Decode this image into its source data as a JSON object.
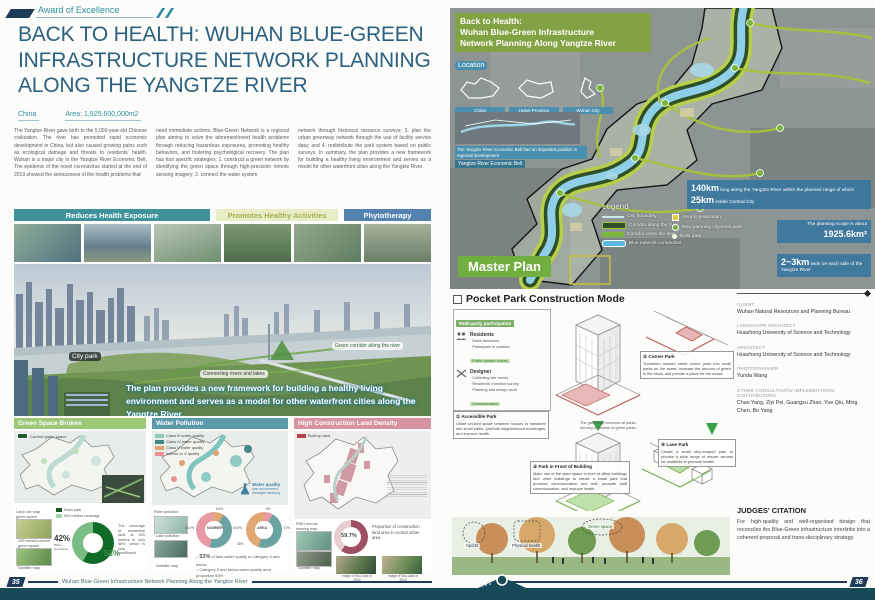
{
  "colors": {
    "accent_teal": "#2e8fa0",
    "title_blue": "#2b607f",
    "footer_navy": "#1e3c5a",
    "banner_teal": "#3f919b",
    "banner_yellow": "#e9edc6",
    "banner_blue": "#5381b0",
    "panel_green": "#9cc878",
    "panel_teal": "#5b9aa8",
    "panel_pink": "#d893a1",
    "callout_blue": "#38769e",
    "master_green": "#6fae3f"
  },
  "award": {
    "label": "Award of Excellence"
  },
  "left": {
    "title": "BACK TO HEALTH: WUHAN BLUE-GREEN INFRASTRUCTURE NETWORK PLANNING ALONG THE YANGTZE RIVER",
    "country": "China",
    "area": "Area: 1,925,600,000m2",
    "intro_col1": "The Yangtze River gave birth to the 5,000-year-old Chinese civilization. The river has promoted rapid economic development in China, but also caused growing pains such as ecological damage and threats to residents' health. Wuhan is a major city in the Yangtze River Economic Belt. The epidemic of the novel coronavirus started at the end of 2019 showed the seriousness of the health problems that",
    "intro_col2": "need immediate actions. Blue-Green Network is a regional plan aiming to solve the aforementioned health problems through reducing hazardous exposures, promoting healthy behaviors, and fostering psychological recovery. The plan has four specific strategies: 1. construct a green network by identifying the green space through high-precision remote sensing imagery; 2. connect the water system",
    "intro_col3": "network through historical resource surveys; 3. plan the urban greenway network through the use of facility service data; and 4. redistribute the park system based on public surveys. In summary, the plan provides a new framework for building a healthy living environment and serves as a model for other waterfront cities along the Yangtze River.",
    "banners": [
      "Reduces Health Exposure",
      "Promotes Healthy Activities",
      "Phytotherapy"
    ],
    "panorama": {
      "label_city_park": "City park",
      "label_corridor": "Green corridor along the river",
      "label_connect": "Connecting rivers and lakes",
      "caption": "The plan provides a new framework for building a healthy living environment and serves as a model for other waterfront cities along the Yangtze River."
    },
    "panels": {
      "green": {
        "title": "Green Space Broken",
        "legend": "Current green space",
        "map_labels": [
          "Land use map green space",
          "GIS extract current green space",
          "Satellite map"
        ],
        "mini_legend": [
          "Each park",
          "500 meters coverage"
        ],
        "donut": {
          "pct_left": "42%",
          "pct_left_sub": "500m uncovered",
          "pct_right": "58%",
          "values": [
            42,
            58
          ]
        },
        "note": "The coverage of residential land at 500 meters is only 58%, which is very insufficient."
      },
      "water": {
        "title": "Water Pollution",
        "legend": [
          "Class III water quality",
          "Class IV water quality",
          "Class V water quality",
          "Inferior to V quality"
        ],
        "flask_title": "Water quality",
        "flask_sub": "river environment damaged seriously",
        "map_labels": [
          "River pollution",
          "Lake pollution",
          "Satellite map"
        ],
        "donuts": [
          {
            "center": "NUMBER",
            "seg1": "8.8%",
            "seg2": "44.8%",
            "seg3": "46.4%",
            "values": [
              8.8,
              44.8,
              46.4
            ]
          },
          {
            "center": "AREA",
            "seg1": "8%",
            "seg2": "47%",
            "seg3": "45%",
            "values": [
              8,
              47,
              45
            ]
          }
        ],
        "note1_pre": "– ",
        "note1_big": "53%",
        "note1_rest": " of lake water quality in Category 5 and below",
        "note2": "– Category 5 and below water quality area proportion 53%"
      },
      "construction": {
        "title": "High Construction Land Density",
        "legend": "Built-up land",
        "map_labels": [
          "RSEI remote sensing map",
          "Satellite map"
        ],
        "donut_pct": "59.7%",
        "note": "Proportion of construction land area in central urban area",
        "images": [
          "Image of Sha Lake in 2000",
          "Image of Sha Lake in 2013"
        ]
      }
    },
    "footer": {
      "page": "35",
      "text": "Wuhan Blue-Green Infrastructure Network Planning Along the Yangtze River"
    }
  },
  "right": {
    "map": {
      "banner1": "Back to Health:",
      "banner2": "Wuhan Blue-Green Infrastructure",
      "banner3": "Network Planning Along Yangtze River",
      "location_label": "Location",
      "mini_maps": [
        "China",
        "Hubei Province",
        "Wuhan City"
      ],
      "econ_caption": "The Yangtze River Economic Belt has an important position in regional development",
      "econ_label": "Yangtze River Economic Belt",
      "master_plan": "Master Plan",
      "legend_title": "Legend",
      "legend_lines": [
        "City boundary",
        "Corridor along the river",
        "Corridor cross the river",
        "Blue network connection"
      ],
      "legend_points": [
        "Area in pedestrian",
        "New planning city-level park",
        "Exist park"
      ],
      "callout1_big1": "140km",
      "callout1_t1": " long along the Yangtze River within the planned range of which ",
      "callout1_big2": "25km",
      "callout1_t2": " inside Central City",
      "callout2_t": "The planning scope is about",
      "callout2_big": "1925.6km²",
      "callout3_big": "2~3km",
      "callout3_t": " wide on each side of the Yangtze River"
    },
    "pocket": {
      "heading": "Pocket Park Construction Mode",
      "participation": {
        "title": "Multi-party participation",
        "g1_name": "Residents",
        "g1_l1": "· Make decisions",
        "g1_l2": "· Participate in creation",
        "g1_tag": "Public opinion survey",
        "g2_name": "Designer",
        "g2_l1": "· Collecting site needs",
        "g2_l2": "· Residents' intention survey",
        "g2_l3": "· Planning and design work",
        "g2_tag": "Communication",
        "g3_name": "Government",
        "g3_l1": "· Organization calls on residents",
        "g3_l2": "· Fund maintenance"
      },
      "note_accessible_t": "① Accessible Park",
      "note_accessible": "Utilize unused space between houses to transform into small parks, promote neighborhood exchanges, and improve health.",
      "note_corner_t": "② Corner Park",
      "note_corner": "Transform unused street corner plots into small parks on the street, increase the amount of green in the block, and provide a place for the crowd.",
      "note_front_t": "③ Park in Front of Building",
      "note_front": "Make use of the open space in front of office buildings and other buildings to create a small park that provides communication and rest, promote staff communication, and improve health.",
      "note_lane_t": "④ Lane Park",
      "note_lane": "Create a small strip-shaped park to provide a wide range of leisure venues for residents to promote health.",
      "greenway_note": "The greenway connects all parks, forming a network of green parks.",
      "render_label1": "Sports",
      "render_label2": "Physical health",
      "render_label3": "Green space"
    },
    "credits": [
      {
        "label": "CLIENT",
        "value": "Wuhan Natural Resources and Planning Bureau"
      },
      {
        "label": "LANDSCAPE ARCHITECT",
        "value": "Huazhong University of Science and Technology"
      },
      {
        "label": "ARCHITECT",
        "value": "Huazhong University of Science and Technology"
      },
      {
        "label": "PHOTOGRAPHER",
        "value": "Yunda Wang"
      },
      {
        "label": "OTHER CONSULTANTS/ IMPLEMENTORS/ CONTRIBUTORS",
        "value": "Chao Yang, Ziyi Pei, Guangsu Zhao, Yue Qiu, Ming Chen, Bo Yang"
      }
    ],
    "citation": {
      "title": "JUDGES' CITATION",
      "text": "For high-quality and well-organised design that reconciles the Blue-Green infrastructure interlinks into a coherent proposal and trans-disciplinary strategy."
    },
    "footer": {
      "page": "36"
    }
  }
}
